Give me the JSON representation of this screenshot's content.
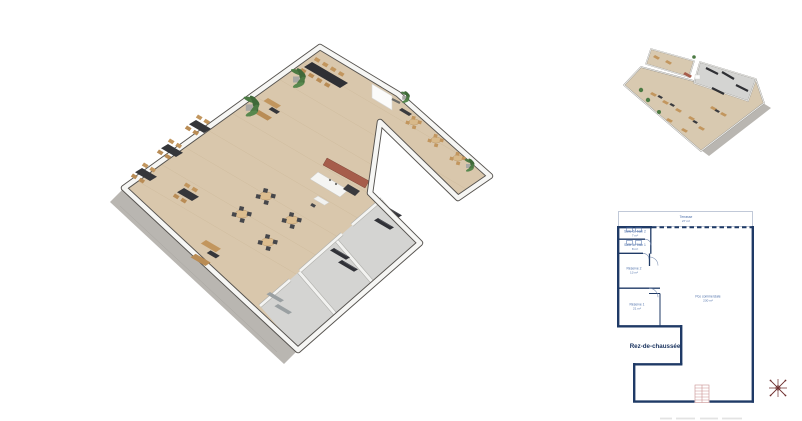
{
  "plan2d": {
    "floor_title": "Rez-de-chaussée",
    "rooms": [
      {
        "label": "Terrasse",
        "area": "27 m²"
      },
      {
        "label": "Salle de bain 2",
        "area": "7 m²"
      },
      {
        "label": "Salle de bain 1",
        "area": "8 m²"
      },
      {
        "label": "Réserve 2",
        "area": "13 m²"
      },
      {
        "label": "Réserve 1",
        "area": "21 m²"
      },
      {
        "label": "Pce commerciale",
        "area": "230 m²"
      }
    ]
  },
  "colors": {
    "plan_wall": "#1f3a66",
    "plan_label": "#4a6da8",
    "stairs": "#c98f8f",
    "compass": "#6f2f2f",
    "wood_floor": "#d9c7ac",
    "concrete_terrace": "#b9b6b1",
    "wall_cap": "#55524e",
    "kitchen_wall": "#a65d4b",
    "table_dark": "#35363a",
    "chair_tan": "#c2965e",
    "plant_green": "#4c7a44"
  }
}
